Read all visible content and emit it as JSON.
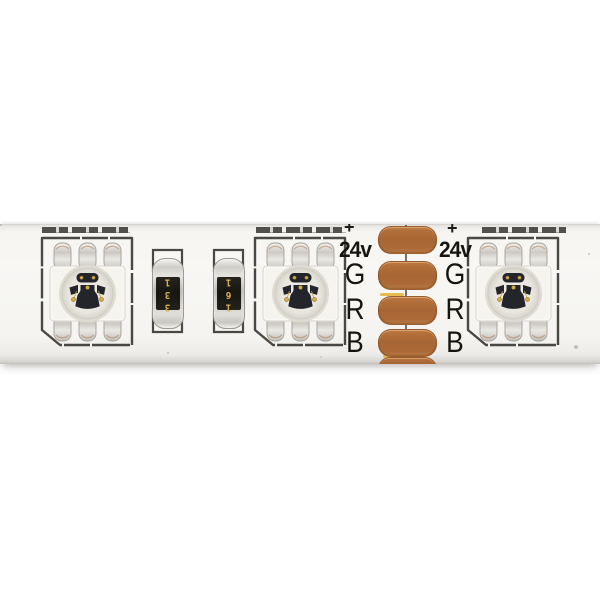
{
  "labels": {
    "voltage": "24v",
    "green": "G",
    "red": "R",
    "blue": "B",
    "plus": "+"
  },
  "resistors": [
    {
      "code": "331"
    },
    {
      "code": "161"
    }
  ],
  "icons": {
    "led_package": "rgb-led-5050-package-icon",
    "resistor": "smd-resistor-icon",
    "solder_pad": "copper-solder-pad"
  },
  "colors": {
    "background": "#ffffff",
    "pcb_white": "#f6f5f2",
    "silkscreen_black": "#2b2925",
    "copper_pad": "#ad6a38",
    "gold_edge": "#e5b544",
    "resistor_code_gold": "#d8b055",
    "component_silver": "#d8d6d1"
  }
}
